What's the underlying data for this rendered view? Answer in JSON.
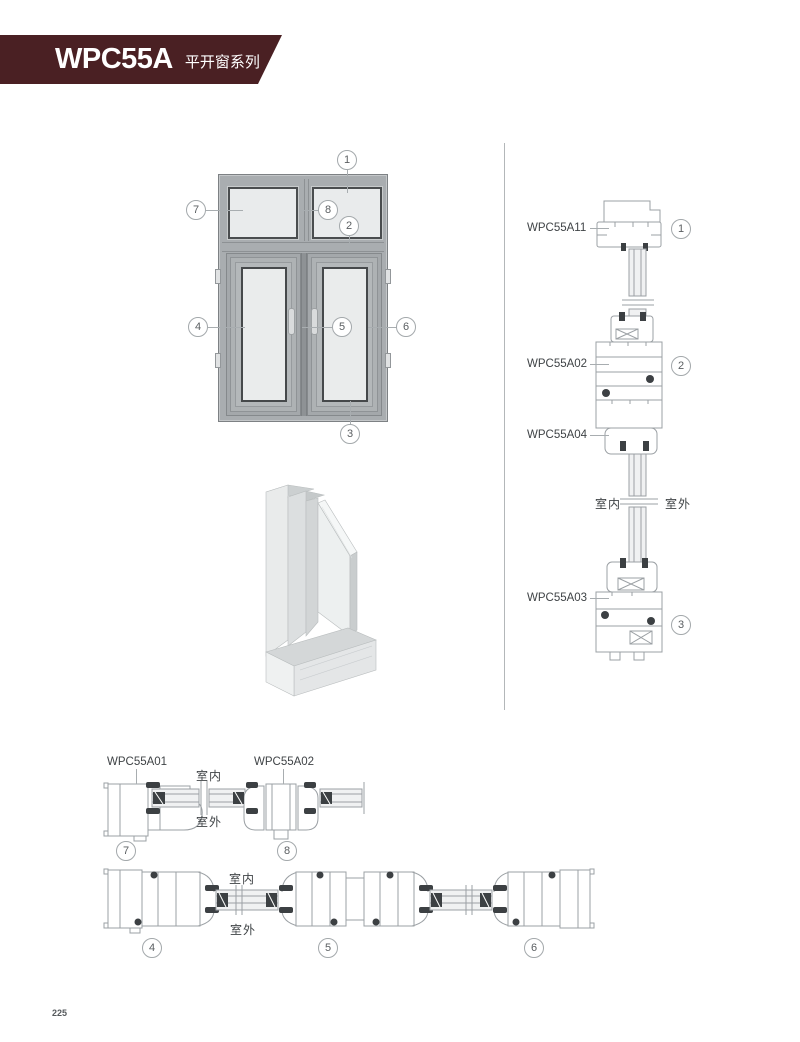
{
  "header": {
    "series_code": "WPC55A",
    "series_name": "平开窗系列"
  },
  "page_number": "225",
  "elevation": {
    "callouts": [
      "1",
      "2",
      "3",
      "4",
      "5",
      "6",
      "7",
      "8"
    ]
  },
  "vertical_section": {
    "labels": [
      {
        "code": "WPC55A11"
      },
      {
        "code": "WPC55A02"
      },
      {
        "code": "WPC55A04"
      },
      {
        "code": "WPC55A03"
      }
    ],
    "callouts": [
      "1",
      "2",
      "3"
    ],
    "indoor": "室内",
    "outdoor": "室外"
  },
  "horizontal_sections": {
    "top": {
      "labels": [
        {
          "code": "WPC55A01"
        },
        {
          "code": "WPC55A02"
        }
      ],
      "callouts": [
        "7",
        "8"
      ],
      "indoor": "室内",
      "outdoor": "室外"
    },
    "bottom": {
      "callouts": [
        "4",
        "5",
        "6"
      ],
      "indoor": "室内",
      "outdoor": "室外"
    }
  },
  "colors": {
    "banner": "#4a2023",
    "drawing_line": "#9ba0a4",
    "frame_gray": "#a9adb0",
    "glass": "#e9ebec"
  }
}
